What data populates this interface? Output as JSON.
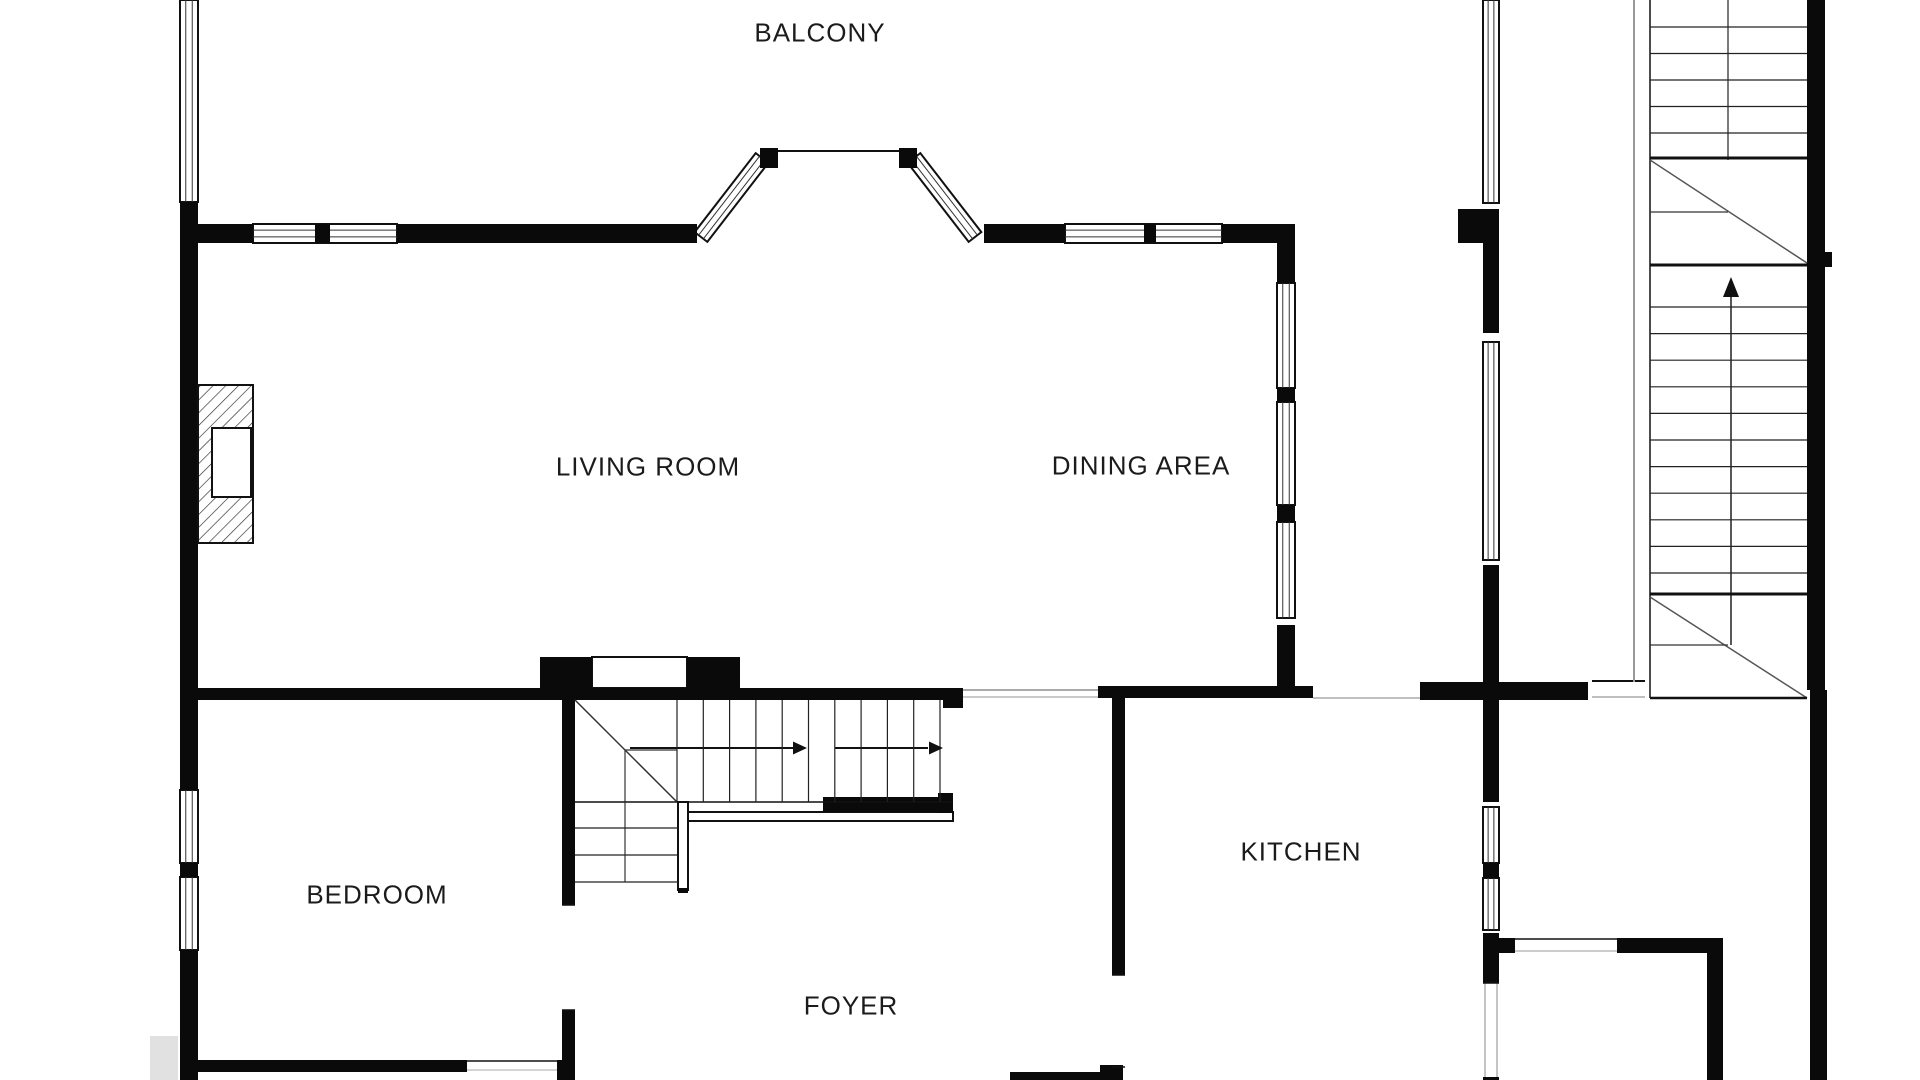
{
  "colors": {
    "background": "#ffffff",
    "wall": "#0a0a0a",
    "thin": "#222222",
    "gray": "#999999",
    "text": "#1b1b1b"
  },
  "rooms": [
    {
      "id": "balcony",
      "label": "BALCONY",
      "cx": 820,
      "cy": 33
    },
    {
      "id": "living-room",
      "label": "LIVING ROOM",
      "cx": 648,
      "cy": 467
    },
    {
      "id": "dining-area",
      "label": "DINING AREA",
      "cx": 1141,
      "cy": 466
    },
    {
      "id": "bedroom",
      "label": "BEDROOM",
      "cx": 377,
      "cy": 895
    },
    {
      "id": "foyer",
      "label": "FOYER",
      "cx": 851,
      "cy": 1006
    },
    {
      "id": "kitchen",
      "label": "KITCHEN",
      "cx": 1301,
      "cy": 852
    }
  ],
  "floorplan": {
    "canvas": {
      "width": 1920,
      "height": 1080
    },
    "walls": [
      [
        180,
        202,
        18,
        8
      ],
      [
        180,
        210,
        18,
        580
      ],
      [
        180,
        863,
        18,
        14
      ],
      [
        180,
        950,
        18,
        130
      ],
      [
        198,
        224,
        55,
        19
      ],
      [
        397,
        224,
        300,
        19
      ],
      [
        984,
        224,
        81,
        19
      ],
      [
        1222,
        224,
        73,
        19
      ],
      [
        315,
        224,
        15,
        19
      ],
      [
        1144,
        224,
        12,
        19
      ],
      [
        760,
        148,
        18,
        20
      ],
      [
        899,
        148,
        18,
        20
      ],
      [
        1458,
        209,
        41,
        34
      ],
      [
        1277,
        243,
        18,
        40
      ],
      [
        1277,
        388,
        18,
        14
      ],
      [
        1277,
        505,
        18,
        17
      ],
      [
        1277,
        625,
        18,
        73
      ],
      [
        1483,
        243,
        16,
        90
      ],
      [
        1483,
        565,
        16,
        237
      ],
      [
        1483,
        863,
        16,
        15
      ],
      [
        1483,
        933,
        16,
        50
      ],
      [
        1483,
        1077,
        16,
        3
      ],
      [
        1499,
        938,
        16,
        15
      ],
      [
        1420,
        682,
        168,
        18
      ],
      [
        198,
        688,
        342,
        12
      ],
      [
        540,
        657,
        52,
        43
      ],
      [
        687,
        657,
        53,
        43
      ],
      [
        592,
        688,
        95,
        12
      ],
      [
        740,
        688,
        223,
        12
      ],
      [
        943,
        700,
        20,
        8
      ],
      [
        1098,
        686,
        215,
        12
      ],
      [
        562,
        698,
        13,
        207
      ],
      [
        562,
        1010,
        13,
        70
      ],
      [
        182,
        1060,
        285,
        12
      ],
      [
        557,
        1060,
        18,
        20
      ],
      [
        823,
        797,
        130,
        15
      ],
      [
        938,
        793,
        15,
        20
      ],
      [
        678,
        888,
        10,
        5
      ],
      [
        1807,
        0,
        18,
        690
      ],
      [
        1810,
        690,
        17,
        390
      ],
      [
        1825,
        252,
        7,
        15
      ],
      [
        1112,
        698,
        13,
        277
      ],
      [
        1100,
        1065,
        23,
        15
      ],
      [
        1010,
        1072,
        113,
        8
      ],
      [
        1617,
        938,
        106,
        15
      ],
      [
        1707,
        953,
        16,
        127
      ]
    ],
    "windows": [
      [
        180,
        0,
        18,
        202,
        "v"
      ],
      [
        180,
        790,
        18,
        73,
        "v"
      ],
      [
        180,
        877,
        18,
        73,
        "v"
      ],
      [
        253,
        224,
        144,
        19,
        "h"
      ],
      [
        1065,
        224,
        157,
        19,
        "h"
      ],
      [
        1277,
        283,
        18,
        105,
        "v"
      ],
      [
        1277,
        402,
        18,
        103,
        "v"
      ],
      [
        1277,
        522,
        18,
        96,
        "v"
      ],
      [
        1483,
        0,
        16,
        203,
        "v"
      ],
      [
        1483,
        342,
        16,
        218,
        "v"
      ],
      [
        1483,
        807,
        16,
        56,
        "v"
      ],
      [
        1483,
        878,
        16,
        52,
        "v"
      ]
    ],
    "white_rects": [
      [
        592,
        657,
        95,
        31
      ],
      [
        678,
        802,
        10,
        88
      ],
      [
        688,
        812,
        265,
        9
      ]
    ],
    "diagonal_windows": [
      [
        701,
        237,
        762,
        158,
        8
      ],
      [
        914,
        158,
        975,
        237,
        8
      ]
    ],
    "lines": [
      [
        778,
        151,
        899,
        151,
        2,
        "#111111"
      ],
      [
        963,
        690,
        1098,
        690,
        1.3,
        "#777777"
      ],
      [
        963,
        697,
        1098,
        697,
        1.2,
        "#aaaaaa"
      ],
      [
        1313,
        698,
        1420,
        698,
        1.2,
        "#999999"
      ],
      [
        1592,
        681,
        1645,
        681,
        2,
        "#111111"
      ],
      [
        1592,
        697,
        1645,
        697,
        1.2,
        "#999999"
      ],
      [
        467,
        1061,
        557,
        1061,
        1.5,
        "#111111"
      ],
      [
        467,
        1070,
        557,
        1070,
        1,
        "#aaaaaa"
      ],
      [
        562,
        905,
        575,
        905,
        1.5,
        "#111111"
      ],
      [
        562,
        1010,
        575,
        1010,
        1.5,
        "#111111"
      ],
      [
        1112,
        975,
        1125,
        975,
        1.5,
        "#111111"
      ],
      [
        1112,
        1067,
        1125,
        1067,
        1.5,
        "#111111"
      ],
      [
        1485,
        983,
        1485,
        1077,
        1,
        "#888888"
      ],
      [
        1497,
        983,
        1497,
        1077,
        1,
        "#888888"
      ],
      [
        1483,
        983,
        1499,
        983,
        1.5,
        "#111111"
      ],
      [
        1515,
        939,
        1617,
        939,
        1.5,
        "#111111"
      ],
      [
        1515,
        951,
        1617,
        951,
        1,
        "#999999"
      ],
      [
        575,
        700,
        677,
        802,
        1.5,
        "#333333"
      ],
      [
        625,
        750,
        677,
        750,
        1.2,
        "#333333"
      ],
      [
        625,
        750,
        625,
        802,
        1.2,
        "#333333"
      ],
      [
        575,
        802,
        953,
        802,
        1.5,
        "#111111"
      ],
      [
        625,
        802,
        625,
        882,
        1.2,
        "#333333"
      ],
      [
        1634,
        0,
        1634,
        682,
        2,
        "#999999"
      ],
      [
        1650,
        0,
        1650,
        698,
        1.5,
        "#111111"
      ],
      [
        1728,
        0,
        1728,
        160,
        1.3,
        "#333333"
      ],
      [
        1650,
        158,
        1807,
        158,
        3,
        "#111111"
      ],
      [
        1650,
        160,
        1807,
        263,
        1.5,
        "#555555"
      ],
      [
        1650,
        212,
        1728,
        212,
        1.2,
        "#333333"
      ],
      [
        1650,
        265,
        1807,
        265,
        3,
        "#111111"
      ],
      [
        1731,
        296,
        1731,
        645,
        1.4,
        "#111111"
      ],
      [
        1650,
        594,
        1807,
        594,
        3,
        "#111111"
      ],
      [
        1650,
        597,
        1807,
        698,
        1.5,
        "#555555"
      ],
      [
        1650,
        645,
        1728,
        645,
        1.2,
        "#333333"
      ],
      [
        1650,
        698,
        1807,
        698,
        2.5,
        "#111111"
      ],
      [
        630,
        748,
        797,
        748,
        2,
        "#111111"
      ],
      [
        835,
        748,
        928,
        748,
        2,
        "#111111"
      ]
    ],
    "tread_sets": [
      [
        1650,
        27,
        1807,
        27,
        0,
        26.5,
        5
      ],
      [
        1650,
        307,
        1807,
        307,
        0,
        26.6,
        11
      ],
      [
        677,
        700,
        677,
        802,
        26.3,
        0,
        11
      ],
      [
        575,
        828,
        678,
        828,
        0,
        27,
        3
      ]
    ],
    "triangles": [
      [
        807,
        748,
        "right"
      ],
      [
        943,
        748,
        "right"
      ],
      [
        1731,
        277,
        "up"
      ]
    ],
    "fireplace": {
      "outer": [
        198,
        385,
        55,
        158
      ],
      "inner": [
        212,
        428,
        39,
        69
      ]
    },
    "artifacts": [
      [
        150,
        1036,
        28,
        44
      ]
    ]
  }
}
